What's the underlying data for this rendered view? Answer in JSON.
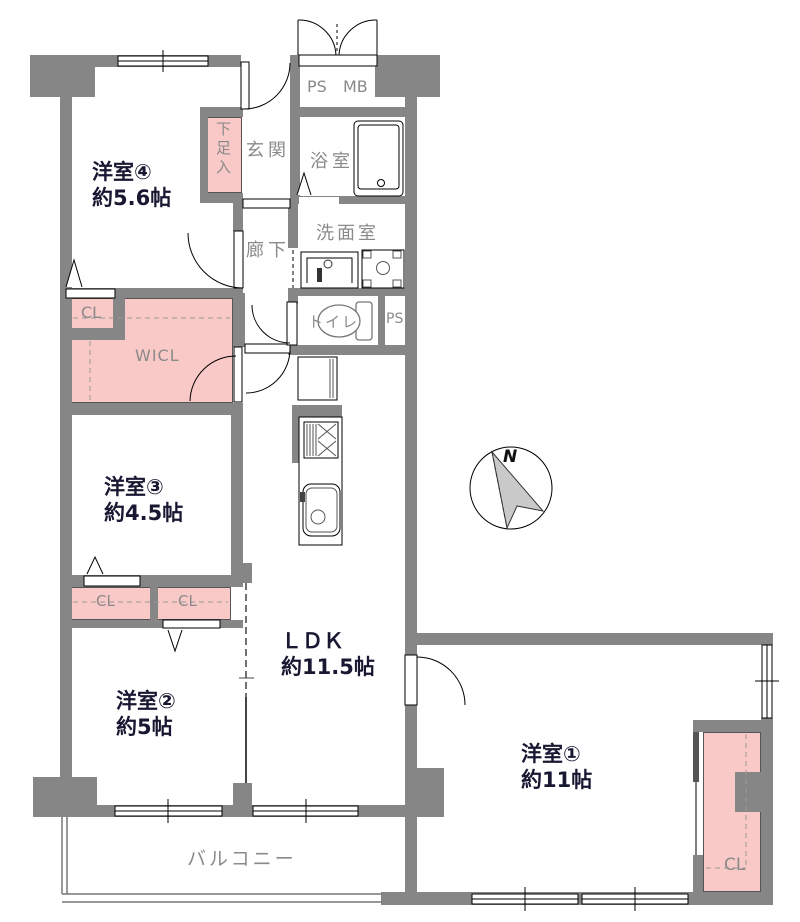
{
  "floorplan": {
    "rooms": {
      "room4": {
        "name": "洋室④",
        "size": "約5.6帖"
      },
      "room3": {
        "name": "洋室③",
        "size": "約4.5帖"
      },
      "room2": {
        "name": "洋室②",
        "size": "約5帖"
      },
      "room1": {
        "name": "洋室①",
        "size": "約11帖"
      },
      "ldk": {
        "name": "ＬＤＫ",
        "size": "約11.5帖"
      }
    },
    "facilities": {
      "genkan": "玄関",
      "hallway": "廊下",
      "bathroom": "浴室",
      "washroom": "洗面室",
      "toilet": "トイレ",
      "balcony": "バルコニー",
      "shoe_cabinet": "下足入",
      "ps_top": "PS",
      "meter_box": "MB",
      "ps_mid": "PS"
    },
    "closets": {
      "closet_upper": "CL",
      "walk_in_closet": "WICL",
      "closet_left": "CL",
      "closet_mid": "CL",
      "closet_room1": "CL"
    },
    "compass": {
      "north": "N"
    },
    "colors": {
      "wall": "#868686",
      "closet_fill": "#f9c9c7",
      "room_label": "#181832",
      "facility_label": "#8a8a8a"
    }
  }
}
